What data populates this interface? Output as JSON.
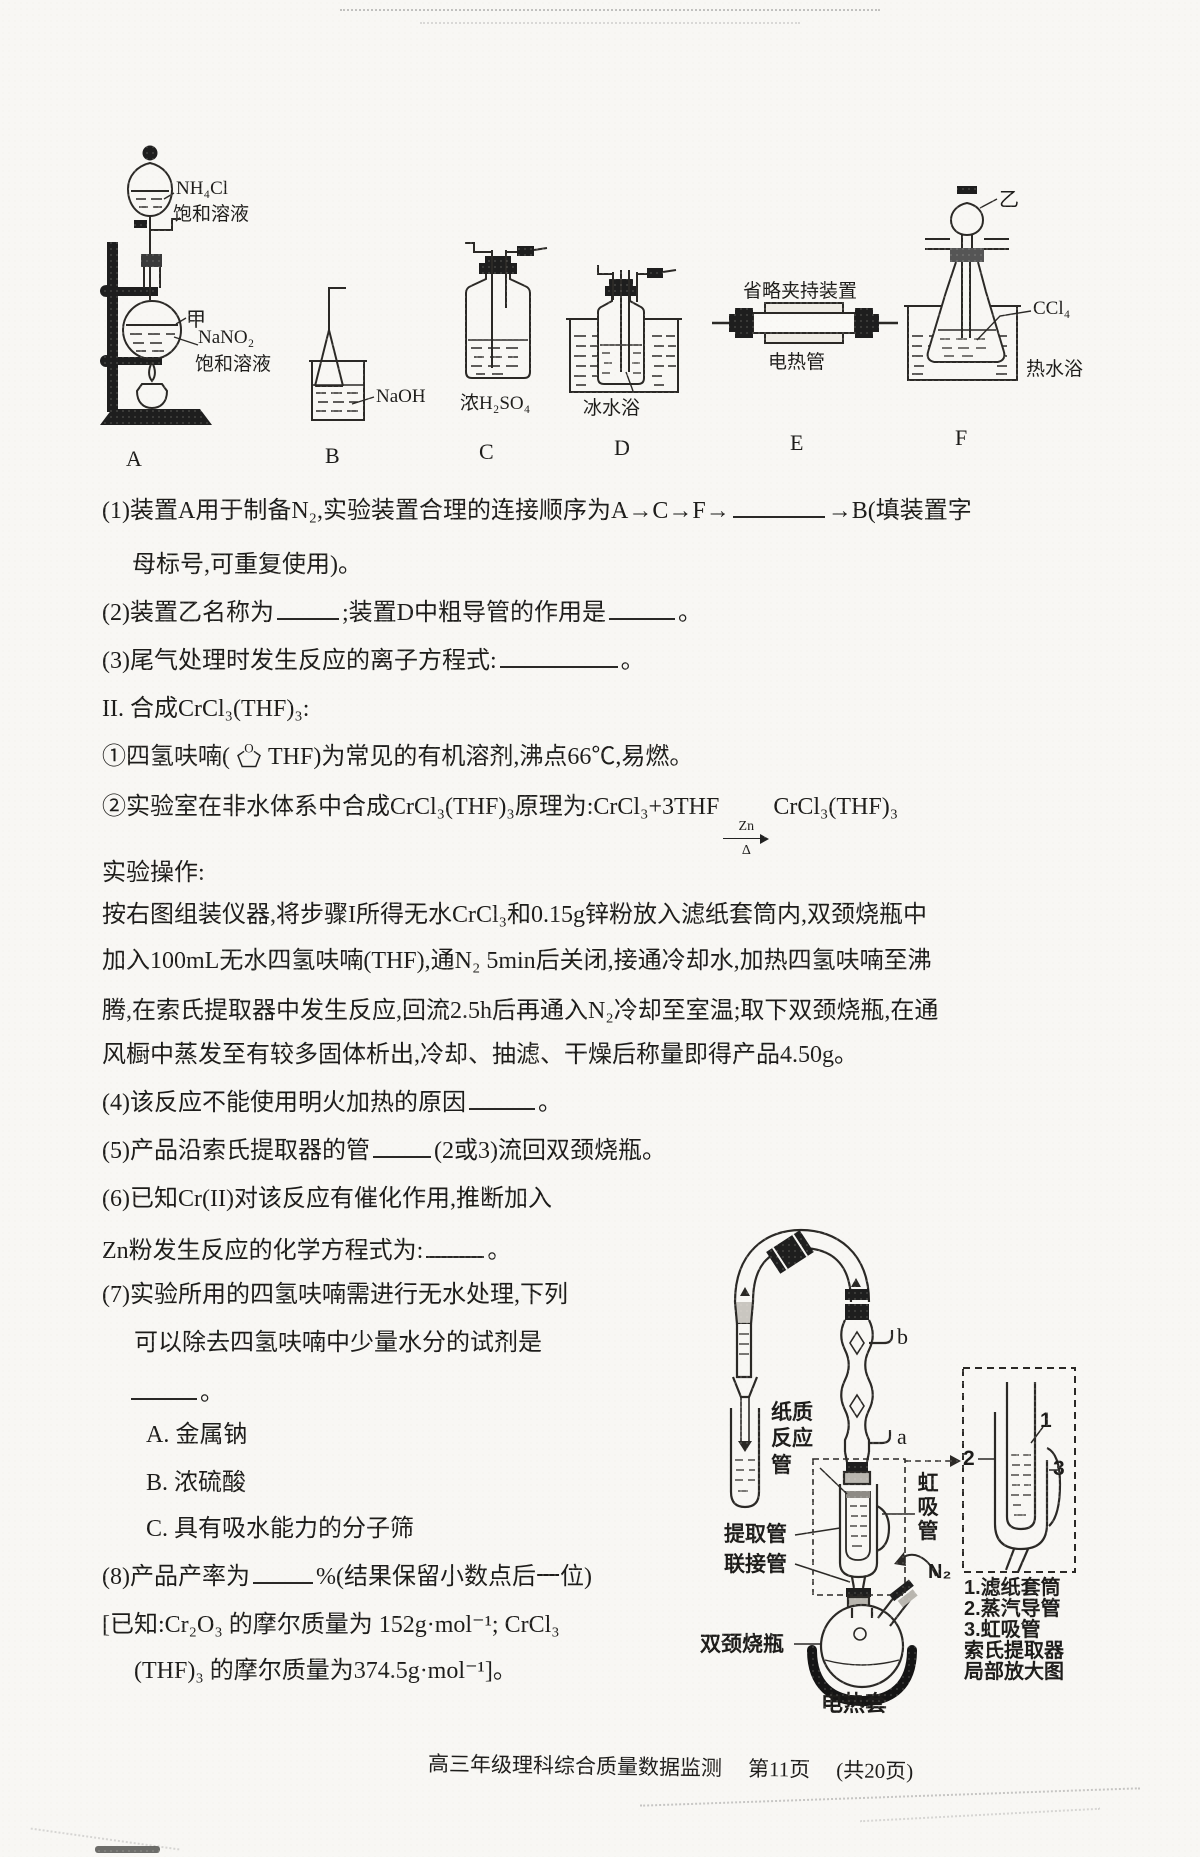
{
  "apparatus": {
    "a": {
      "label": "A",
      "solution_top": "NH₄Cl",
      "solution_top2": "饱和溶液",
      "flask_mark": "甲",
      "solution_bottom": "NaNO₂",
      "solution_bottom2": "饱和溶液"
    },
    "b": {
      "label": "B",
      "reagent": "NaOH"
    },
    "c": {
      "label": "C",
      "reagent": "浓H₂SO₄"
    },
    "d": {
      "label": "D",
      "bath": "冰水浴"
    },
    "e": {
      "label": "E",
      "note_top": "省略夹持装置",
      "note_bottom": "电热管"
    },
    "f": {
      "label": "F",
      "device_mark": "乙",
      "reagent": "CCl₄",
      "bath": "热水浴"
    }
  },
  "body": {
    "q1_pre": "(1)装置A用于制备N₂,实验装置合理的连接顺序为A→C→F→",
    "q1_post": "→B(填装置字",
    "q1_cont": "母标号,可重复使用)。",
    "q2_pre": "(2)装置乙名称为",
    "q2_mid": ";装置D中粗导管的作用是",
    "q2_end": "。",
    "q3_pre": "(3)尾气处理时发生反应的离子方程式:",
    "q3_end": "。",
    "sec2": "II. 合成CrCl₃(THF)₃:",
    "n1_pre": "①四氢呋喃(",
    "thf_o": "O",
    "n1_post": "THF)为常见的有机溶剂,沸点66℃,易燃。",
    "n2_pre": "②实验室在非水体系中合成CrCl₃(THF)₃原理为:CrCl₃+3THF",
    "n2_arrow_top": "Zn",
    "n2_arrow_bot": "Δ",
    "n2_post": "CrCl₃(THF)₃",
    "op_title": "实验操作:",
    "p1": "按右图组装仪器,将步骤I所得无水CrCl₃和0.15g锌粉放入滤纸套筒内,双颈烧瓶中",
    "p2": "加入100mL无水四氢呋喃(THF),通N₂ 5min后关闭,接通冷却水,加热四氢呋喃至沸",
    "p3": "腾,在索氏提取器中发生反应,回流2.5h后再通入N₂冷却至室温;取下双颈烧瓶,在通",
    "p4": "风橱中蒸发至有较多固体析出,冷却、抽滤、干燥后称量即得产品4.50g。",
    "q4_pre": "(4)该反应不能使用明火加热的原因",
    "q4_end": "。",
    "q5_pre": "(5)产品沿索氏提取器的管",
    "q5_post": "(2或3)流回双颈烧瓶。",
    "q6_l1": "(6)已知Cr(II)对该反应有催化作用,推断加入",
    "q6_l2_pre": "Zn粉发生反应的化学方程式为:",
    "q6_l2_end": "。",
    "q7_l1": "(7)实验所用的四氢呋喃需进行无水处理,下列",
    "q7_l2": "可以除去四氢呋喃中少量水分的试剂是",
    "q7_end": "。",
    "optA": "A. 金属钠",
    "optB": "B. 浓硫酸",
    "optC": "C. 具有吸水能力的分子筛",
    "q8_pre": "(8)产品产率为",
    "q8_post": "%(结果保留小数点后一位)",
    "known1": "[已知:Cr₂O₃ 的摩尔质量为 152g·mol⁻¹; CrCl₃",
    "known2": "(THF)₃ 的摩尔质量为374.5g·mol⁻¹]。"
  },
  "soxhlet": {
    "b": "b",
    "a": "a",
    "paper_tube": "纸质反应管",
    "extract_tube": "提取管",
    "connect_tube": "联接管",
    "siphon_tube": "虹吸管",
    "n2": "N₂",
    "flask": "双颈烧瓶",
    "mantle": "电热套"
  },
  "inset": {
    "n1": "1",
    "n2": "2",
    "n3": "3",
    "cap1": "1.滤纸套筒",
    "cap2": "2.蒸汽导管",
    "cap3": "3.虹吸管",
    "cap4": "索氏提取器",
    "cap5": "局部放大图"
  },
  "footer": {
    "title": "高三年级理科综合质量数据监测",
    "page": "第11页",
    "total": "(共20页)"
  }
}
